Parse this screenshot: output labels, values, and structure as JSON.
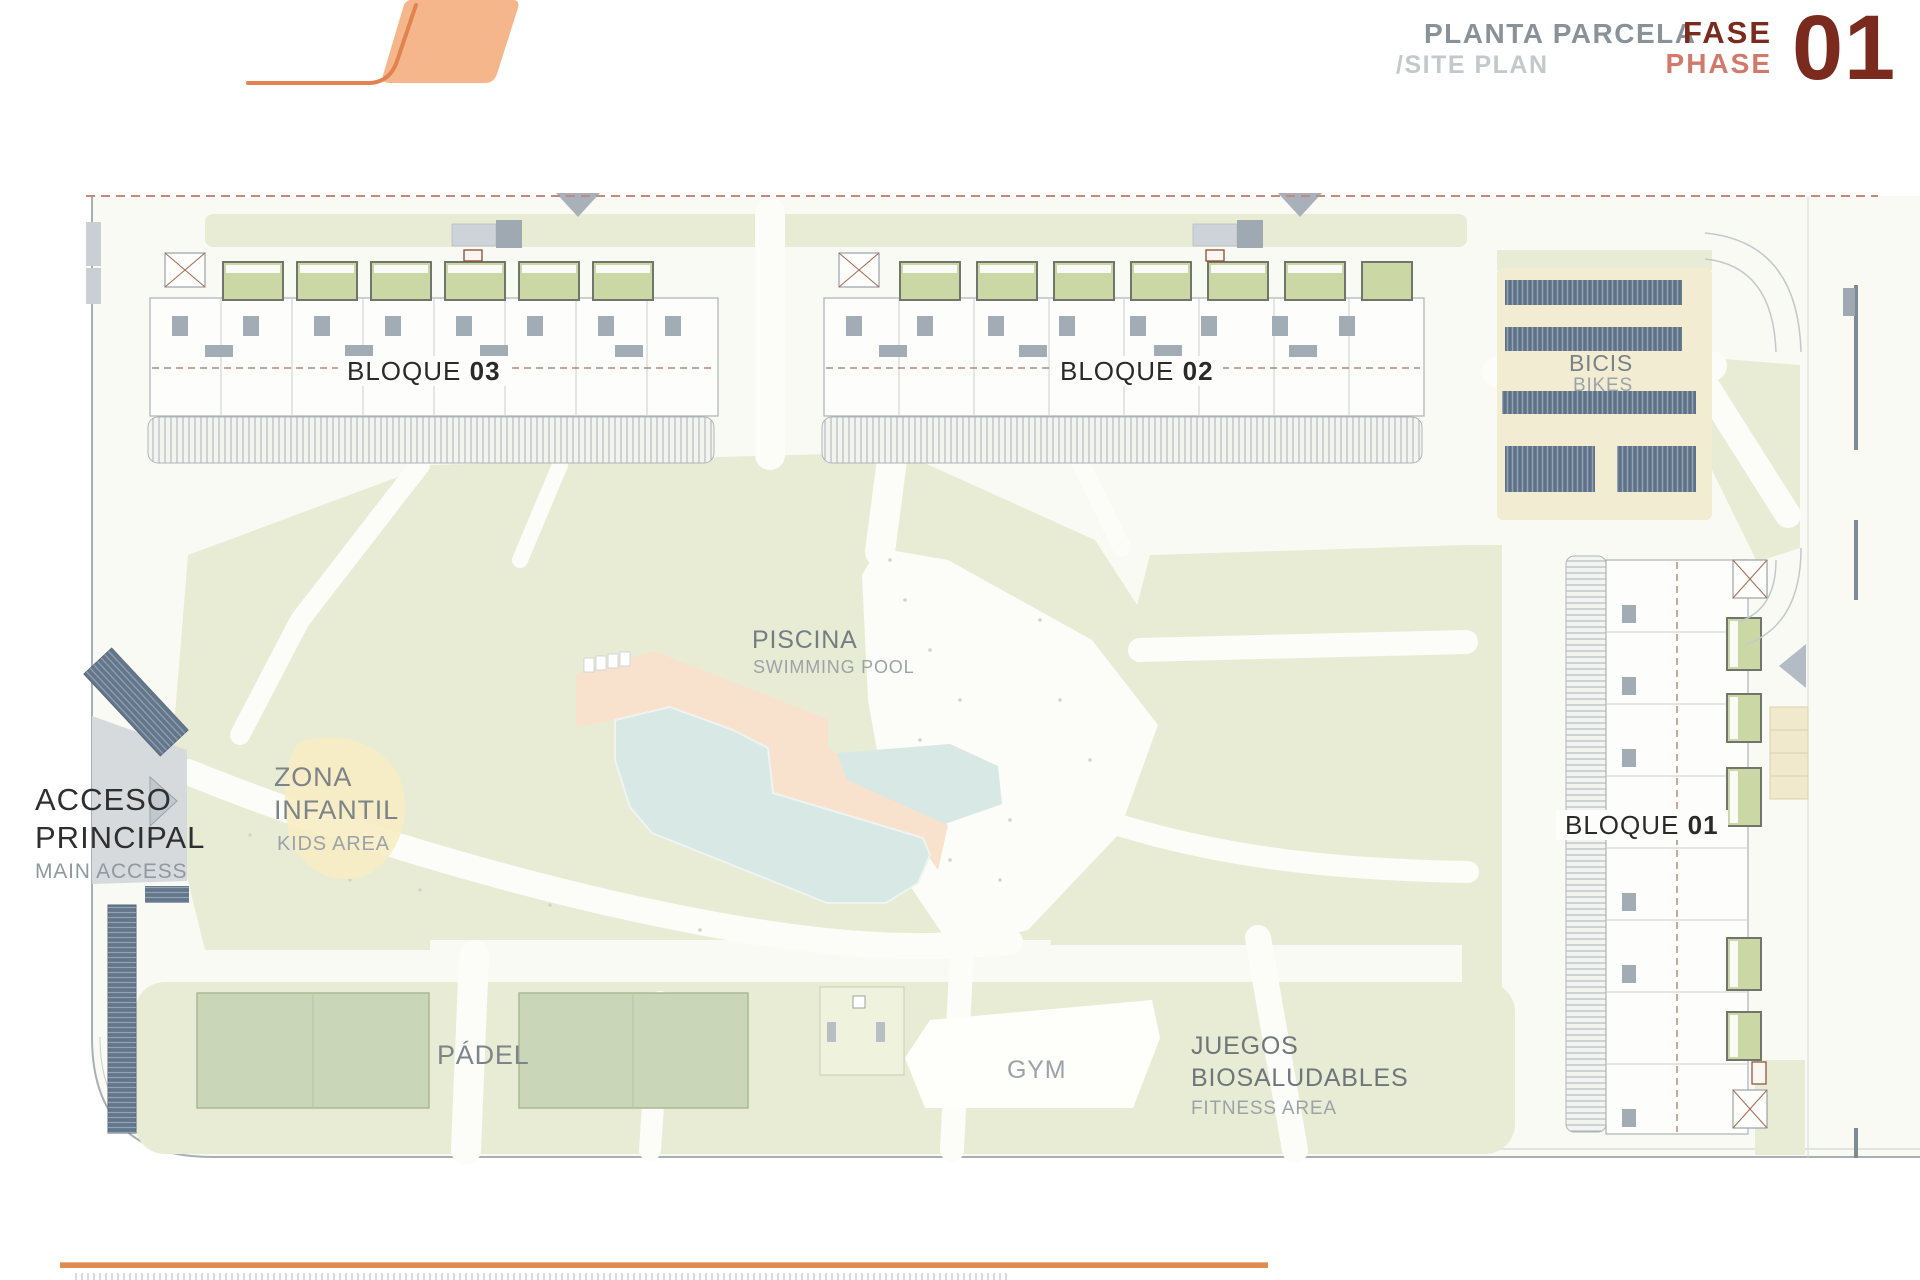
{
  "header": {
    "title_primary": "PLANTA PARCELA",
    "title_secondary": "/SITE PLAN",
    "phase_word_es": "FASE",
    "phase_word_en": "PHASE",
    "phase_number": "01"
  },
  "plan": {
    "blocks": [
      {
        "name": "BLOQUE",
        "number": "03"
      },
      {
        "name": "BLOQUE",
        "number": "02"
      },
      {
        "name": "BLOQUE",
        "number": "01"
      }
    ],
    "labels": {
      "bikes_es": "BICIS",
      "bikes_en": "BIKES",
      "pool_es": "PISCINA",
      "pool_en": "SWIMMING POOL",
      "kids_es1": "ZONA",
      "kids_es2": "INFANTIL",
      "kids_en": "KIDS AREA",
      "access_es1": "ACCESO",
      "access_es2": "PRINCIPAL",
      "access_en": "MAIN ACCESS",
      "padel": "PÁDEL",
      "gym": "GYM",
      "fitness_es1": "JUEGOS",
      "fitness_es2": "BIOSALUDABLES",
      "fitness_en": "FITNESS AREA"
    },
    "colors": {
      "accent_orange": "#E8935C",
      "phase_dark_red": "#7B2A1E",
      "phase_light_red": "#D17A6B",
      "landscape_green": "#E9ECD4",
      "court_green": "#C9D6B8",
      "terrace_green": "#CBD8A6",
      "pool_water": "#D8E8E5",
      "pool_deck": "#F8E2CD",
      "bike_rack_blue": "#5F7186",
      "sand_beige": "#F2ECD2",
      "road_gray": "#D6DADC",
      "kids_yellow": "#F7EDC4",
      "boundary_dash_red": "#C4897B"
    }
  }
}
